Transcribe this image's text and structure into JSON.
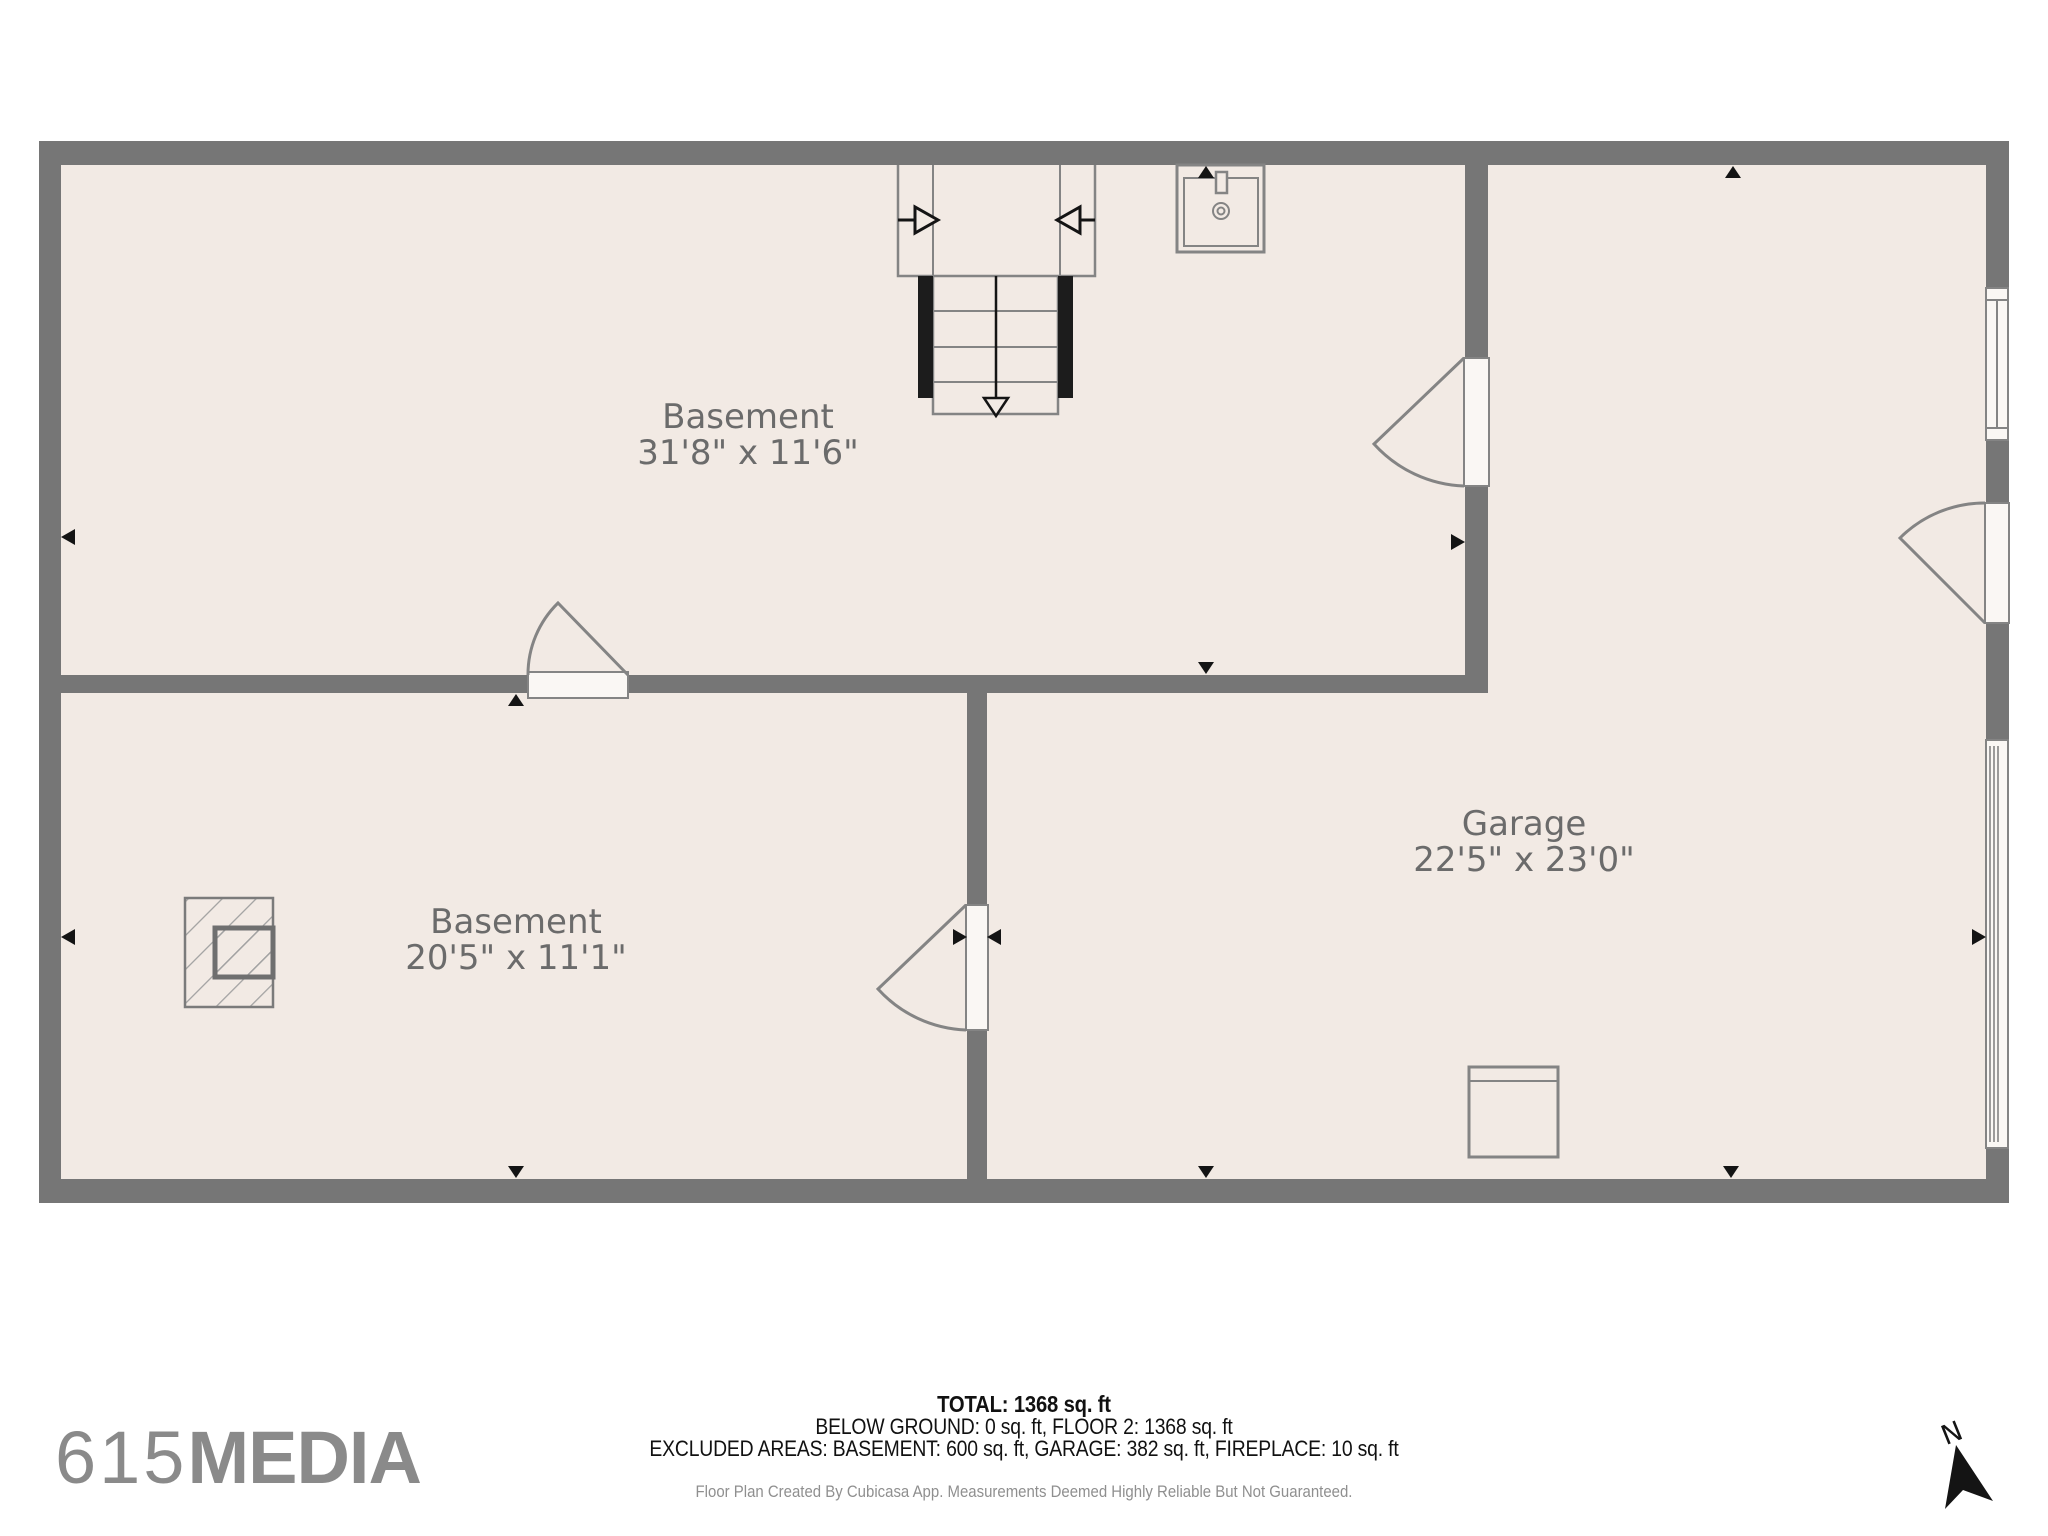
{
  "plan": {
    "rooms": [
      {
        "id": "basement-upper",
        "name": "Basement",
        "dims": "31'8\" x 11'6\""
      },
      {
        "id": "basement-lower",
        "name": "Basement",
        "dims": "20'5\" x 11'1\""
      },
      {
        "id": "garage",
        "name": "Garage",
        "dims": "22'5\" x 23'0\""
      }
    ],
    "fixtures": [
      "staircase-with-entry-arrows",
      "sink",
      "fireplace",
      "appliance-square",
      "window-right-wall",
      "garage-door-right-wall",
      "4-swing-doors",
      "wall-direction-markers"
    ]
  },
  "summary": {
    "total": "TOTAL: 1368 sq. ft",
    "line2": "BELOW GROUND: 0 sq. ft, FLOOR 2: 1368 sq. ft",
    "line3": "EXCLUDED AREAS: BASEMENT: 600 sq. ft, GARAGE: 382 sq. ft, FIREPLACE: 10 sq. ft",
    "disclaimer": "Floor Plan Created By Cubicasa App. Measurements Deemed Highly Reliable But Not Guaranteed."
  },
  "branding": {
    "logo_prefix": "615",
    "logo_suffix": "MEDIA"
  },
  "compass": {
    "north_label": "N"
  },
  "colors": {
    "wall": "#767676",
    "room_fill": "#F2EAE4",
    "line": "#848484",
    "leaf_fill": "#FAF7F4",
    "marker": "#141414",
    "label": "#6B6B6B",
    "logo": "#8A8A8A",
    "note": "#8F8F8F",
    "text": "#111111"
  }
}
